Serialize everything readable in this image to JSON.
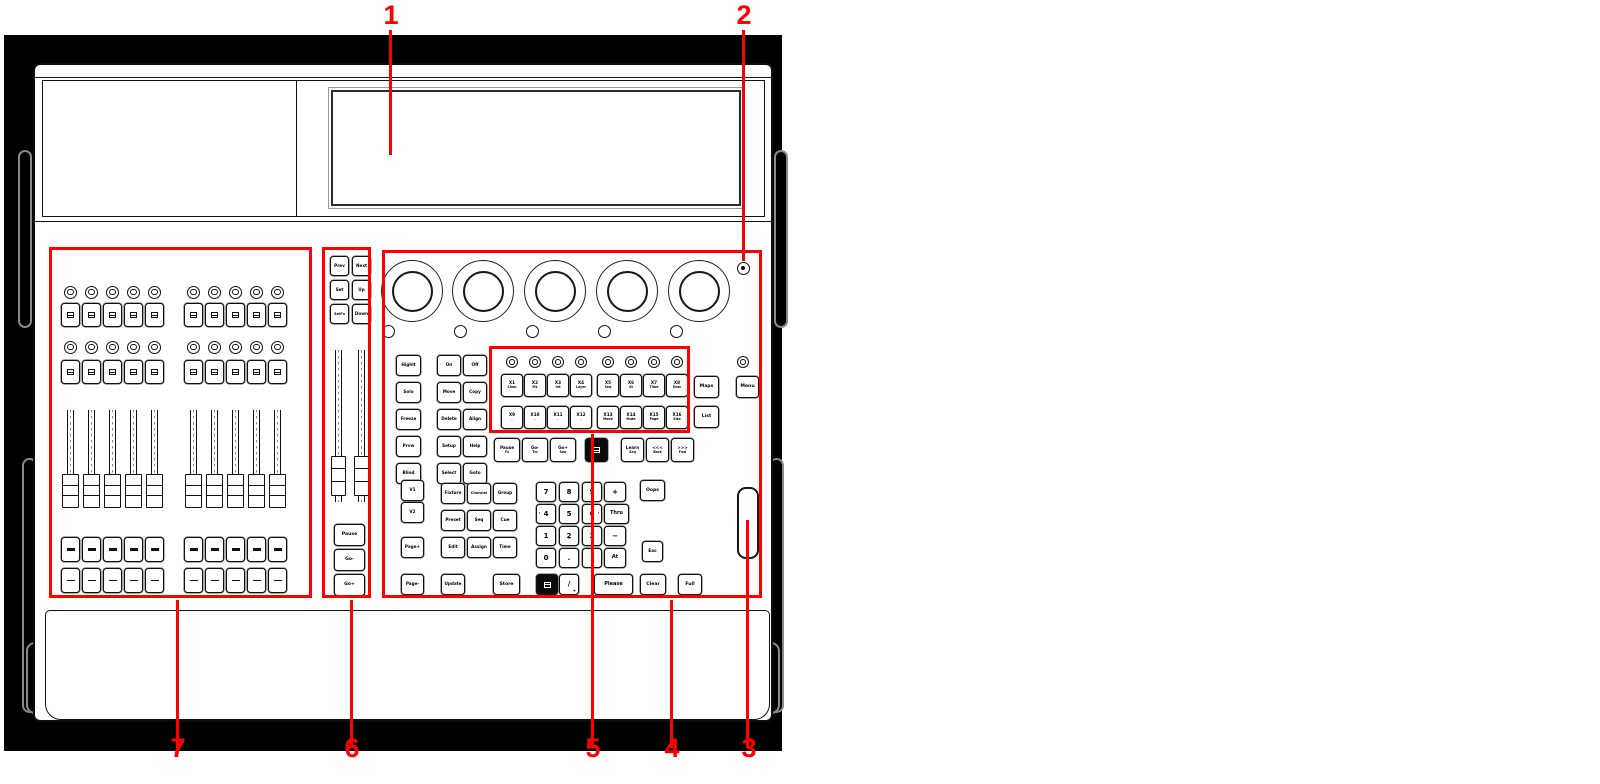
{
  "colors": {
    "annotation": "#fe0000",
    "ink": "#111111",
    "backdrop": "#000000",
    "panel": "#ffffff",
    "handle": "#8a8a8a"
  },
  "callouts": [
    {
      "num": "1",
      "cx": 391,
      "ty": 2,
      "lx": 389,
      "ly1": 30,
      "ly2": 155
    },
    {
      "num": "2",
      "cx": 744,
      "ty": 2,
      "lx": 742,
      "ly1": 30,
      "ly2": 261
    },
    {
      "num": "3",
      "cx": 749,
      "ty": 735,
      "lx": 746,
      "ly1": 520,
      "ly2": 748
    },
    {
      "num": "4",
      "cx": 672,
      "ty": 735,
      "lx": 670,
      "ly1": 600,
      "ly2": 748
    },
    {
      "num": "5",
      "cx": 593,
      "ty": 735,
      "lx": 591,
      "ly1": 434,
      "ly2": 748
    },
    {
      "num": "6",
      "cx": 352,
      "ty": 735,
      "lx": 350,
      "ly1": 600,
      "ly2": 748
    },
    {
      "num": "7",
      "cx": 178,
      "ty": 735,
      "lx": 176,
      "ly1": 600,
      "ly2": 748
    }
  ],
  "region_boxes": [
    {
      "id": "region-7-fader-bank",
      "x": 49,
      "y": 247,
      "w": 263,
      "h": 351
    },
    {
      "id": "region-6-main-playback",
      "x": 322,
      "y": 247,
      "w": 49,
      "h": 351
    },
    {
      "id": "region-4-command-section",
      "x": 382,
      "y": 250,
      "w": 380,
      "h": 348
    },
    {
      "id": "region-5-x-keys",
      "x": 489,
      "y": 346,
      "w": 201,
      "h": 87
    }
  ],
  "frame": {
    "backdrop": {
      "x": 4,
      "y": 35,
      "w": 778,
      "h": 716
    },
    "body": {
      "x": 33,
      "y": 63,
      "w": 740,
      "h": 659
    },
    "top_seam_y": 77,
    "deck": {
      "x": 42,
      "y": 80,
      "w": 723,
      "h": 137
    },
    "deck_divider_x": 296,
    "screen": {
      "x": 331,
      "y": 90,
      "w": 410,
      "h": 116
    },
    "face_seam_y": 221,
    "wrist_rest": {
      "x": 45,
      "y": 610,
      "w": 725,
      "h": 110
    },
    "handles": [
      {
        "x": 18,
        "y": 150,
        "w": 14,
        "h": 178
      },
      {
        "x": 22,
        "y": 458,
        "w": 15,
        "h": 255
      },
      {
        "x": 774,
        "y": 150,
        "w": 14,
        "h": 178
      },
      {
        "x": 769,
        "y": 458,
        "w": 15,
        "h": 255
      },
      {
        "x": 26,
        "y": 642,
        "w": 18,
        "h": 72
      },
      {
        "x": 762,
        "y": 642,
        "w": 18,
        "h": 72
      }
    ]
  },
  "encoders": {
    "cy": 291,
    "outer_d": 62,
    "inner_inset": 9.5,
    "cx": [
      412,
      483,
      555,
      627,
      699
    ],
    "push_led_cy": 331,
    "push_led_cx": [
      388,
      460,
      532,
      604,
      676
    ],
    "push_led_d": 13
  },
  "indicator_top_right": {
    "cx": 743,
    "cy": 268,
    "d": 13
  },
  "x_leds": {
    "cy": 362,
    "d": 12,
    "cx": [
      512,
      535,
      558,
      581,
      608,
      631,
      654,
      677
    ]
  },
  "menu_led": {
    "cx": 743,
    "cy": 362,
    "d": 12
  },
  "left_bank": {
    "centers": [
      70.5,
      91.5,
      112.5,
      133.5,
      154.5,
      193.5,
      214.5,
      235.5,
      256.5,
      277.5
    ],
    "btn_w": 19,
    "led_d": 13,
    "rows": [
      {
        "type": "led",
        "cy": 292
      },
      {
        "type": "btn",
        "y": 303,
        "h": 24,
        "glyph": "icon",
        "name": "bank-flash-button"
      },
      {
        "type": "led",
        "cy": 347
      },
      {
        "type": "btn",
        "y": 360,
        "h": 24,
        "glyph": "icon",
        "name": "bank-flash-button"
      },
      {
        "type": "btn",
        "y": 537,
        "h": 25,
        "glyph": "bar",
        "name": "bank-go-button"
      },
      {
        "type": "btn",
        "y": 568,
        "h": 25,
        "glyph": "dash",
        "name": "bank-select-button"
      }
    ],
    "fader": {
      "track_w": 7,
      "track_y": 410,
      "track_h": 92,
      "cap_w": 17,
      "cap_y": 474,
      "cap_h": 34
    }
  },
  "main_faders": {
    "centers": [
      338,
      361
    ],
    "track_w": 7,
    "track_y": 350,
    "track_h": 152,
    "cap_w": 15,
    "cap_y": 456,
    "cap_h": 40
  },
  "wheel": {
    "x": 737,
    "y": 487,
    "w": 22,
    "h": 72
  },
  "keys": [
    {
      "n": "prev-key",
      "l": "Prev",
      "x": 330,
      "y": 256,
      "w": 19,
      "h": 20
    },
    {
      "n": "next-key",
      "l": "Next",
      "x": 352,
      "y": 256,
      "w": 19,
      "h": 20
    },
    {
      "n": "set-key",
      "l": "Set",
      "x": 330,
      "y": 280,
      "w": 19,
      "h": 20
    },
    {
      "n": "up-key",
      "l": "Up",
      "x": 352,
      "y": 280,
      "w": 19,
      "h": 20
    },
    {
      "n": "selfx-key",
      "l": "SelFx",
      "x": 330,
      "y": 304,
      "w": 19,
      "h": 20,
      "fs": 3.6
    },
    {
      "n": "down-key",
      "l": "Down",
      "x": 352,
      "y": 304,
      "w": 19,
      "h": 20
    },
    {
      "n": "pause-main-key",
      "l": "Pause",
      "x": 334,
      "y": 524,
      "w": 31,
      "h": 22,
      "fs": 4.6
    },
    {
      "n": "go-minus-main-key",
      "l": "Go-",
      "x": 334,
      "y": 549,
      "w": 31,
      "h": 22,
      "fs": 4.6
    },
    {
      "n": "go-plus-main-key",
      "l": "Go+",
      "x": 334,
      "y": 574,
      "w": 31,
      "h": 22,
      "fs": 4.6
    },
    {
      "n": "highlight-key",
      "l": "Highlt",
      "x": 396,
      "y": 355,
      "w": 25,
      "h": 21
    },
    {
      "n": "solo-key",
      "l": "Solo",
      "x": 396,
      "y": 382,
      "w": 25,
      "h": 21
    },
    {
      "n": "freeze-key",
      "l": "Freeze",
      "x": 396,
      "y": 409,
      "w": 25,
      "h": 21
    },
    {
      "n": "preview-key",
      "l": "Prvw",
      "x": 396,
      "y": 436,
      "w": 25,
      "h": 21
    },
    {
      "n": "blind-key",
      "l": "Blind",
      "x": 396,
      "y": 463,
      "w": 25,
      "h": 21
    },
    {
      "n": "on-key",
      "l": "On",
      "x": 437,
      "y": 355,
      "w": 24,
      "h": 21
    },
    {
      "n": "off-key",
      "l": "Off",
      "x": 463,
      "y": 355,
      "w": 24,
      "h": 21
    },
    {
      "n": "move-key",
      "l": "Move",
      "x": 437,
      "y": 382,
      "w": 24,
      "h": 21
    },
    {
      "n": "copy-key",
      "l": "Copy",
      "x": 463,
      "y": 382,
      "w": 24,
      "h": 21
    },
    {
      "n": "delete-key",
      "l": "Delete",
      "x": 437,
      "y": 409,
      "w": 24,
      "h": 21
    },
    {
      "n": "align-key",
      "l": "Align",
      "x": 463,
      "y": 409,
      "w": 24,
      "h": 21
    },
    {
      "n": "setup-key",
      "l": "Setup",
      "x": 437,
      "y": 436,
      "w": 24,
      "h": 21
    },
    {
      "n": "help-key",
      "l": "Help",
      "x": 463,
      "y": 436,
      "w": 24,
      "h": 21
    },
    {
      "n": "select-key",
      "l": "Select",
      "x": 437,
      "y": 463,
      "w": 24,
      "h": 21
    },
    {
      "n": "goto-key",
      "l": "Goto",
      "x": 463,
      "y": 463,
      "w": 24,
      "h": 21
    },
    {
      "n": "x1-key",
      "l": "X1",
      "s": "Chan",
      "x": 501,
      "y": 374,
      "w": 22,
      "h": 23
    },
    {
      "n": "x2-key",
      "l": "X2",
      "s": "ML",
      "x": 524,
      "y": 374,
      "w": 22,
      "h": 23
    },
    {
      "n": "x3-key",
      "l": "X3",
      "s": "Int",
      "x": 547,
      "y": 374,
      "w": 22,
      "h": 23
    },
    {
      "n": "x4-key",
      "l": "X4",
      "s": "Layer",
      "x": 570,
      "y": 374,
      "w": 22,
      "h": 23
    },
    {
      "n": "x5-key",
      "l": "X5",
      "s": "Seq",
      "x": 597,
      "y": 374,
      "w": 22,
      "h": 23
    },
    {
      "n": "x6-key",
      "l": "X6",
      "s": "St",
      "x": 620,
      "y": 374,
      "w": 22,
      "h": 23
    },
    {
      "n": "x7-key",
      "l": "X7",
      "s": "Time",
      "x": 643,
      "y": 374,
      "w": 22,
      "h": 23
    },
    {
      "n": "x8-key",
      "l": "X8",
      "s": "Exec",
      "x": 666,
      "y": 374,
      "w": 22,
      "h": 23
    },
    {
      "n": "x9-key",
      "l": "X9",
      "s": ".",
      "x": 501,
      "y": 406,
      "w": 22,
      "h": 23
    },
    {
      "n": "x10-key",
      "l": "X10",
      "s": ".",
      "x": 524,
      "y": 406,
      "w": 22,
      "h": 23
    },
    {
      "n": "x11-key",
      "l": "X11",
      "s": ".",
      "x": 547,
      "y": 406,
      "w": 22,
      "h": 23
    },
    {
      "n": "x12-key",
      "l": "X12",
      "s": ".",
      "x": 570,
      "y": 406,
      "w": 22,
      "h": 23
    },
    {
      "n": "x13-key",
      "l": "X13",
      "s": "Move",
      "x": 597,
      "y": 406,
      "w": 22,
      "h": 23
    },
    {
      "n": "x14-key",
      "l": "X14",
      "s": "Mute",
      "x": 620,
      "y": 406,
      "w": 22,
      "h": 23
    },
    {
      "n": "x15-key",
      "l": "X15",
      "s": "Page",
      "x": 643,
      "y": 406,
      "w": 22,
      "h": 23
    },
    {
      "n": "x16-key",
      "l": "X16",
      "s": "Size",
      "x": 666,
      "y": 406,
      "w": 22,
      "h": 23
    },
    {
      "n": "maps-key",
      "l": "Maps",
      "x": 694,
      "y": 376,
      "w": 25,
      "h": 22,
      "fs": 4.6
    },
    {
      "n": "list-key",
      "l": "List",
      "x": 694,
      "y": 406,
      "w": 25,
      "h": 22,
      "fs": 4.6
    },
    {
      "n": "menu-key",
      "l": "Menu",
      "x": 736,
      "y": 376,
      "w": 23,
      "h": 22,
      "fs": 4.6
    },
    {
      "n": "pause-fx-key",
      "l": "Pause",
      "s": "Fx",
      "x": 494,
      "y": 438,
      "w": 26,
      "h": 24
    },
    {
      "n": "go-minus-key",
      "l": "Go-",
      "s": "Tm",
      "x": 522,
      "y": 438,
      "w": 26,
      "h": 24
    },
    {
      "n": "go-plus-key",
      "l": "Go+",
      "s": "Seq",
      "x": 550,
      "y": 438,
      "w": 26,
      "h": 24
    },
    {
      "n": "black-display-key",
      "x": 585,
      "y": 438,
      "w": 23,
      "h": 24,
      "black": true,
      "glyph": "icon-light"
    },
    {
      "n": "learn-key",
      "l": "Learn",
      "s": "Seq",
      "x": 621,
      "y": 438,
      "w": 23,
      "h": 24
    },
    {
      "n": "fast-back-key",
      "l": "<<<",
      "s": "Back",
      "x": 646,
      "y": 438,
      "w": 23,
      "h": 24
    },
    {
      "n": "fast-forward-key",
      "l": ">>>",
      "s": "Fwd",
      "x": 671,
      "y": 438,
      "w": 23,
      "h": 24
    },
    {
      "n": "v1-key",
      "l": "V1",
      "x": 401,
      "y": 480,
      "w": 23,
      "h": 21
    },
    {
      "n": "v2-key",
      "l": "V2",
      "x": 401,
      "y": 502,
      "w": 23,
      "h": 21
    },
    {
      "n": "page-plus-key",
      "l": "Page+",
      "x": 401,
      "y": 537,
      "w": 23,
      "h": 21
    },
    {
      "n": "page-minus-key",
      "l": "Page-",
      "x": 401,
      "y": 574,
      "w": 23,
      "h": 21
    },
    {
      "n": "fixture-key",
      "l": "Fixture",
      "x": 441,
      "y": 483,
      "w": 24,
      "h": 21
    },
    {
      "n": "channel-key",
      "l": "Channel",
      "x": 467,
      "y": 483,
      "w": 24,
      "h": 21,
      "fs": 3.6
    },
    {
      "n": "group-key",
      "l": "Group",
      "x": 493,
      "y": 483,
      "w": 24,
      "h": 21
    },
    {
      "n": "preset-key",
      "l": "Preset",
      "x": 441,
      "y": 510,
      "w": 24,
      "h": 21
    },
    {
      "n": "seq-key",
      "l": "Seq",
      "x": 467,
      "y": 510,
      "w": 24,
      "h": 21
    },
    {
      "n": "cue-key",
      "l": "Cue",
      "x": 493,
      "y": 510,
      "w": 24,
      "h": 21
    },
    {
      "n": "edit-key",
      "l": "Edit",
      "x": 441,
      "y": 537,
      "w": 24,
      "h": 21
    },
    {
      "n": "assign-key",
      "l": "Assign",
      "x": 467,
      "y": 537,
      "w": 24,
      "h": 21
    },
    {
      "n": "time-key",
      "l": "Time",
      "x": 493,
      "y": 537,
      "w": 24,
      "h": 21
    },
    {
      "n": "update-key",
      "l": "Update",
      "x": 441,
      "y": 574,
      "w": 24,
      "h": 21
    },
    {
      "n": "store-key",
      "l": "Store",
      "x": 493,
      "y": 574,
      "w": 27,
      "h": 21,
      "fs": 4.6
    },
    {
      "n": "digit-7-key",
      "l": "7",
      "x": 536,
      "y": 482,
      "w": 20,
      "h": 20,
      "cls": "digit"
    },
    {
      "n": "digit-8-key",
      "l": "8",
      "x": 559,
      "y": 482,
      "w": 20,
      "h": 20,
      "cls": "digit",
      "arrow": "up"
    },
    {
      "n": "digit-9-key",
      "l": "9",
      "x": 582,
      "y": 482,
      "w": 20,
      "h": 20,
      "cls": "digit"
    },
    {
      "n": "plus-key",
      "l": "+",
      "x": 604,
      "y": 482,
      "w": 22,
      "h": 20,
      "cls": "digit"
    },
    {
      "n": "digit-4-key",
      "l": "4",
      "x": 536,
      "y": 504,
      "w": 20,
      "h": 20,
      "cls": "digit",
      "arrow": "left"
    },
    {
      "n": "digit-5-key",
      "l": "5",
      "x": 559,
      "y": 504,
      "w": 20,
      "h": 20,
      "cls": "digit"
    },
    {
      "n": "digit-6-key",
      "l": "6",
      "x": 582,
      "y": 504,
      "w": 20,
      "h": 20,
      "cls": "digit",
      "arrow": "right"
    },
    {
      "n": "thru-key",
      "l": "Thru",
      "x": 604,
      "y": 504,
      "w": 25,
      "h": 20,
      "fs": 5
    },
    {
      "n": "digit-1-key",
      "l": "1",
      "x": 536,
      "y": 526,
      "w": 20,
      "h": 20,
      "cls": "digit"
    },
    {
      "n": "digit-2-key",
      "l": "2",
      "x": 559,
      "y": 526,
      "w": 20,
      "h": 20,
      "cls": "digit",
      "arrow": "down"
    },
    {
      "n": "digit-3-key",
      "l": "3",
      "x": 582,
      "y": 526,
      "w": 20,
      "h": 20,
      "cls": "digit"
    },
    {
      "n": "minus-key",
      "l": "−",
      "x": 604,
      "y": 526,
      "w": 22,
      "h": 20,
      "cls": "digit"
    },
    {
      "n": "digit-0-key",
      "l": "0",
      "x": 536,
      "y": 548,
      "w": 20,
      "h": 20,
      "cls": "digit"
    },
    {
      "n": "dot-key",
      "l": ".",
      "x": 559,
      "y": 548,
      "w": 20,
      "h": 20,
      "cls": "digit"
    },
    {
      "n": "spare-key",
      "x": 582,
      "y": 548,
      "w": 20,
      "h": 20
    },
    {
      "n": "at-key",
      "l": "At",
      "x": 604,
      "y": 548,
      "w": 22,
      "h": 20,
      "fs": 5
    },
    {
      "n": "black-command-key",
      "x": 536,
      "y": 574,
      "w": 22,
      "h": 21,
      "black": true,
      "glyph": "icon-light"
    },
    {
      "n": "slash-key",
      "l": "/",
      "x": 559,
      "y": 574,
      "w": 20,
      "h": 21,
      "cls": "digit",
      "corner": "+"
    },
    {
      "n": "please-key",
      "l": "Please",
      "x": 594,
      "y": 574,
      "w": 39,
      "h": 21,
      "fs": 5
    },
    {
      "n": "oops-key",
      "l": "Oops",
      "x": 640,
      "y": 480,
      "w": 25,
      "h": 21,
      "fs": 4.6
    },
    {
      "n": "esc-key",
      "l": "Esc",
      "x": 642,
      "y": 541,
      "w": 21,
      "h": 21,
      "fs": 4.6
    },
    {
      "n": "clear-key",
      "l": "Clear",
      "x": 640,
      "y": 574,
      "w": 26,
      "h": 21,
      "fs": 4.6
    },
    {
      "n": "full-key",
      "l": "Full",
      "x": 678,
      "y": 574,
      "w": 24,
      "h": 21,
      "fs": 4.6
    }
  ]
}
